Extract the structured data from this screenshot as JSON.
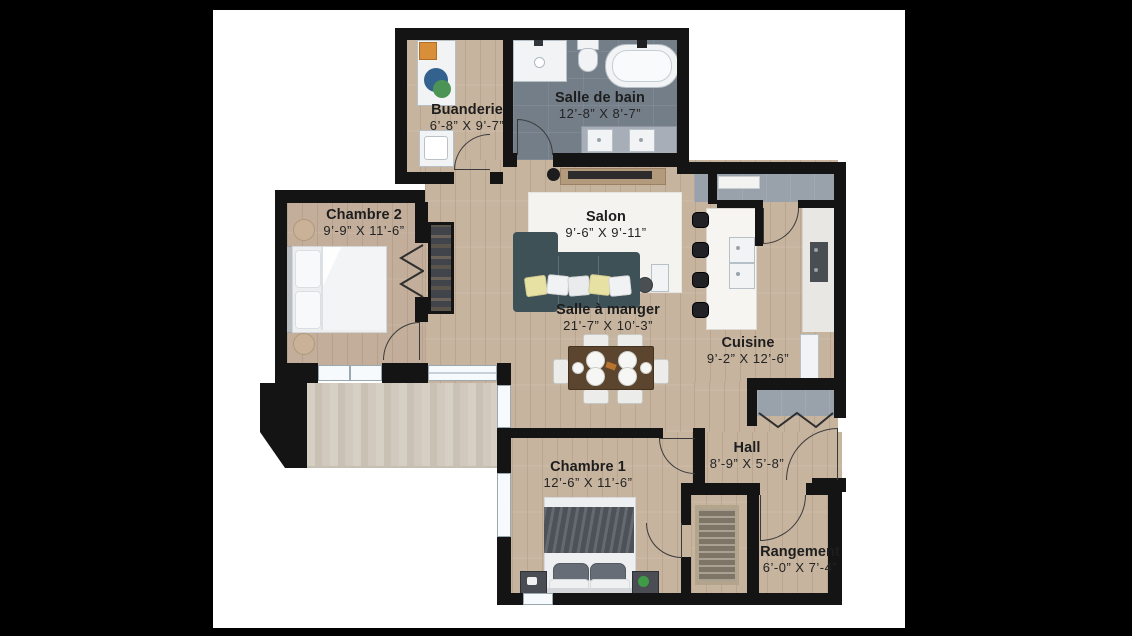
{
  "rooms": [
    {
      "id": "buanderie",
      "name": "Buanderie",
      "dims": "6’-8” X 9’-7”"
    },
    {
      "id": "salle-de-bain",
      "name": "Salle de bain",
      "dims": "12’-8” X 8’-7”"
    },
    {
      "id": "chambre-2",
      "name": "Chambre 2",
      "dims": "9’-9” X 11’-6”"
    },
    {
      "id": "salon",
      "name": "Salon",
      "dims": "9’-6” X 9’-11”"
    },
    {
      "id": "salle-a-manger",
      "name": "Salle à manger",
      "dims": "21’-7” X 10’-3”"
    },
    {
      "id": "cuisine",
      "name": "Cuisine",
      "dims": "9’-2” X 12’-6”"
    },
    {
      "id": "hall",
      "name": "Hall",
      "dims": "8’-9” X 5’-8”"
    },
    {
      "id": "chambre-1",
      "name": "Chambre 1",
      "dims": "12’-6” X 11’-6”"
    },
    {
      "id": "rangement",
      "name": "Rangement",
      "dims": "6’-0” X 7’-4”"
    }
  ],
  "colors": {
    "background": "#000000",
    "canvas": "#ffffff",
    "wall": "#141414",
    "wood_floor": "#c7b49f",
    "tile_floor": "#747e89",
    "balcony_floor": "#d0c8bc",
    "sofa": "#3e5156",
    "table_wood": "#5b452e"
  }
}
